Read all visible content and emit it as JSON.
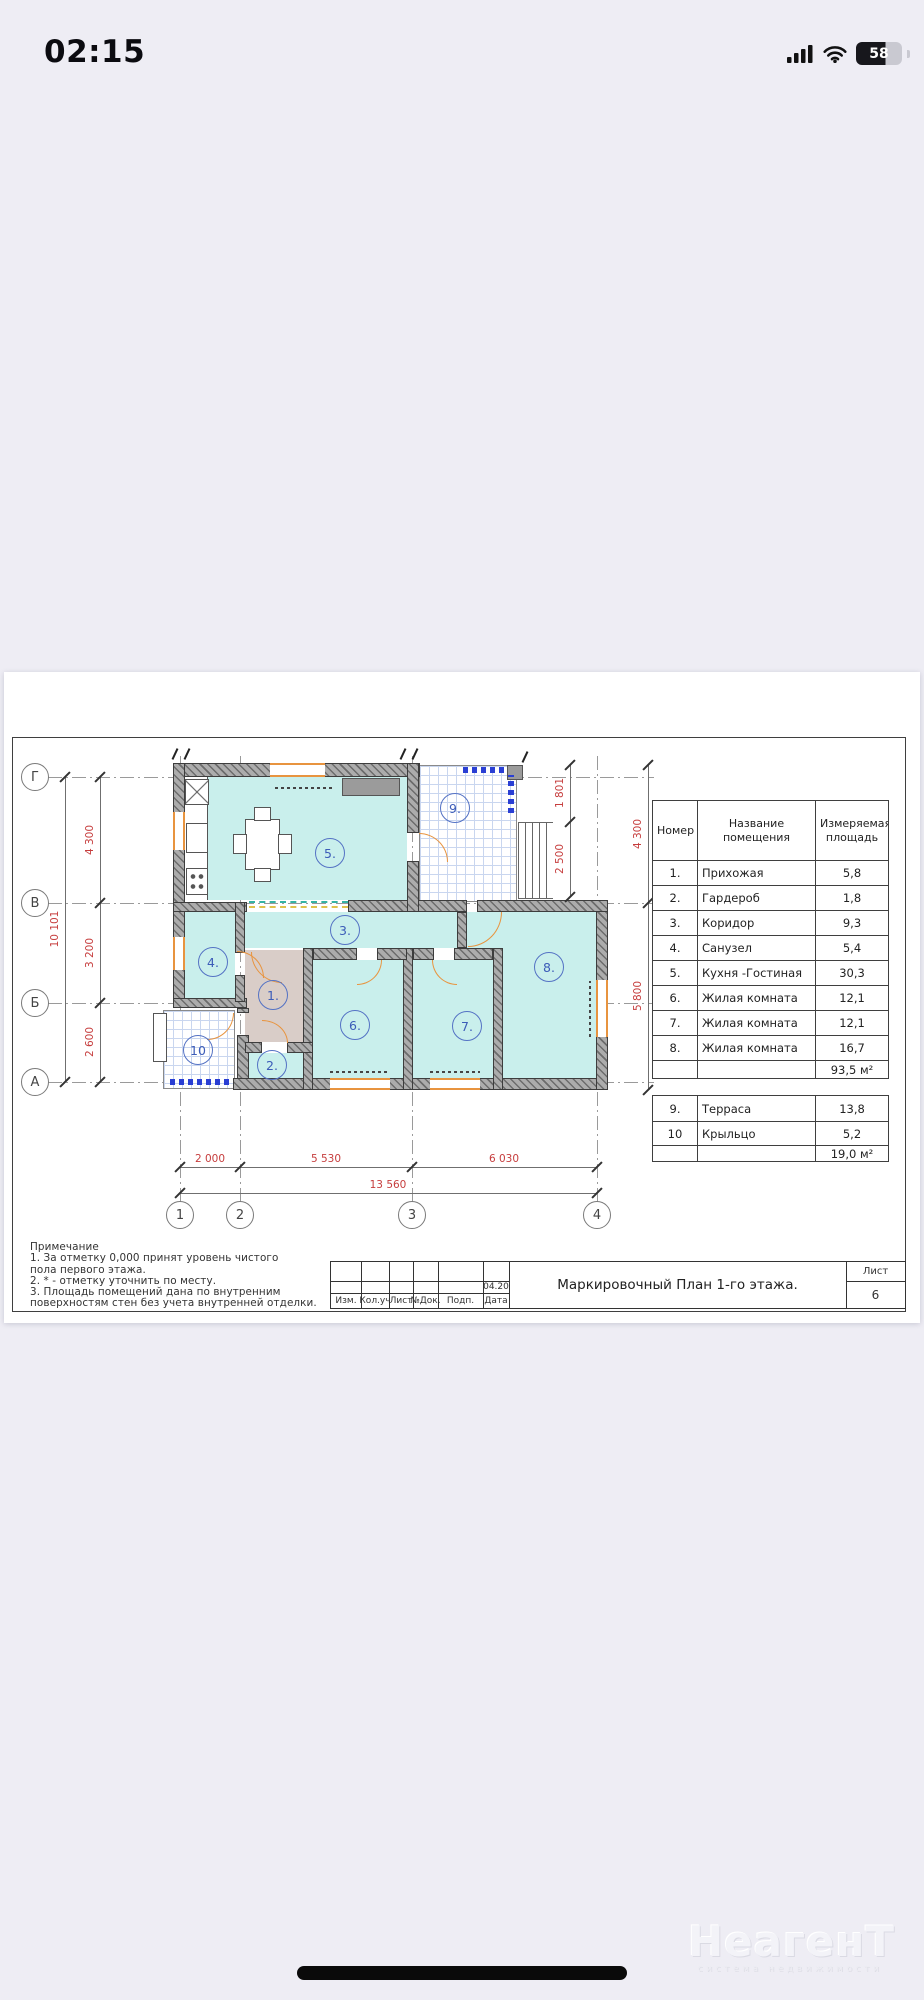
{
  "status_bar": {
    "time": "02:15",
    "battery": "58"
  },
  "plan": {
    "axes_rows": [
      "Г",
      "В",
      "Б",
      "А"
    ],
    "axes_cols": [
      "1",
      "2",
      "3",
      "4"
    ],
    "dims_left": [
      "4 300",
      "3 200",
      "2 600"
    ],
    "dim_left_total": "10 101",
    "dims_bottom": [
      "2 000",
      "5 530",
      "6 030"
    ],
    "dim_bottom_total": "13 560",
    "dims_right_inner": [
      "1 801",
      "2 500"
    ],
    "dims_right_outer": [
      "4 300",
      "5 800"
    ],
    "room_labels": [
      "1.",
      "2.",
      "3.",
      "4.",
      "5.",
      "6.",
      "7.",
      "8.",
      "9.",
      "10"
    ]
  },
  "tables": {
    "main": {
      "headers": [
        "Номер",
        "Название помещения",
        "Измеряемая площадь"
      ],
      "rows": [
        [
          "1.",
          "Прихожая",
          "5,8"
        ],
        [
          "2.",
          "Гардероб",
          "1,8"
        ],
        [
          "3.",
          "Коридор",
          "9,3"
        ],
        [
          "4.",
          "Санузел",
          "5,4"
        ],
        [
          "5.",
          "Кухня -Гостиная",
          "30,3"
        ],
        [
          "6.",
          "Жилая комната",
          "12,1"
        ],
        [
          "7.",
          "Жилая комната",
          "12,1"
        ],
        [
          "8.",
          "Жилая комната",
          "16,7"
        ]
      ],
      "total": "93,5 м²"
    },
    "extra": {
      "rows": [
        [
          "9.",
          "Терраса",
          "13,8"
        ],
        [
          "10",
          "Крыльцо",
          "5,2"
        ]
      ],
      "total": "19,0 м²"
    }
  },
  "notes": {
    "title": "Примечание",
    "lines": [
      "1. За отметку 0,000 принят уровень чистого",
      "пола первого этажа.",
      "2. * - отметку уточнить по месту.",
      "3. Площадь помещений дана по внутренним",
      "поверхностям стен без учета внутренней отделки."
    ]
  },
  "title_block": {
    "cols": [
      "Изм.",
      "Кол.уч",
      "Лист",
      "№Док.",
      "Подп.",
      "Дата"
    ],
    "date": "04.20",
    "title": "Маркировочный План 1-го этажа.",
    "sheet_label": "Лист",
    "sheet_number": "6"
  },
  "watermark": {
    "title": "НеагенТ",
    "subtitle": "система недвижимости"
  },
  "colors": {
    "page_bg": "#eeedf4",
    "room_fill": "#c9efec",
    "hall_fill": "#d9cdc8",
    "wall": "#acacac",
    "accent_orange": "#e8943f",
    "dim_red": "#c63d3d",
    "plan_blue": "#3c5cb8",
    "grid_blue": "#c9d6ef"
  }
}
